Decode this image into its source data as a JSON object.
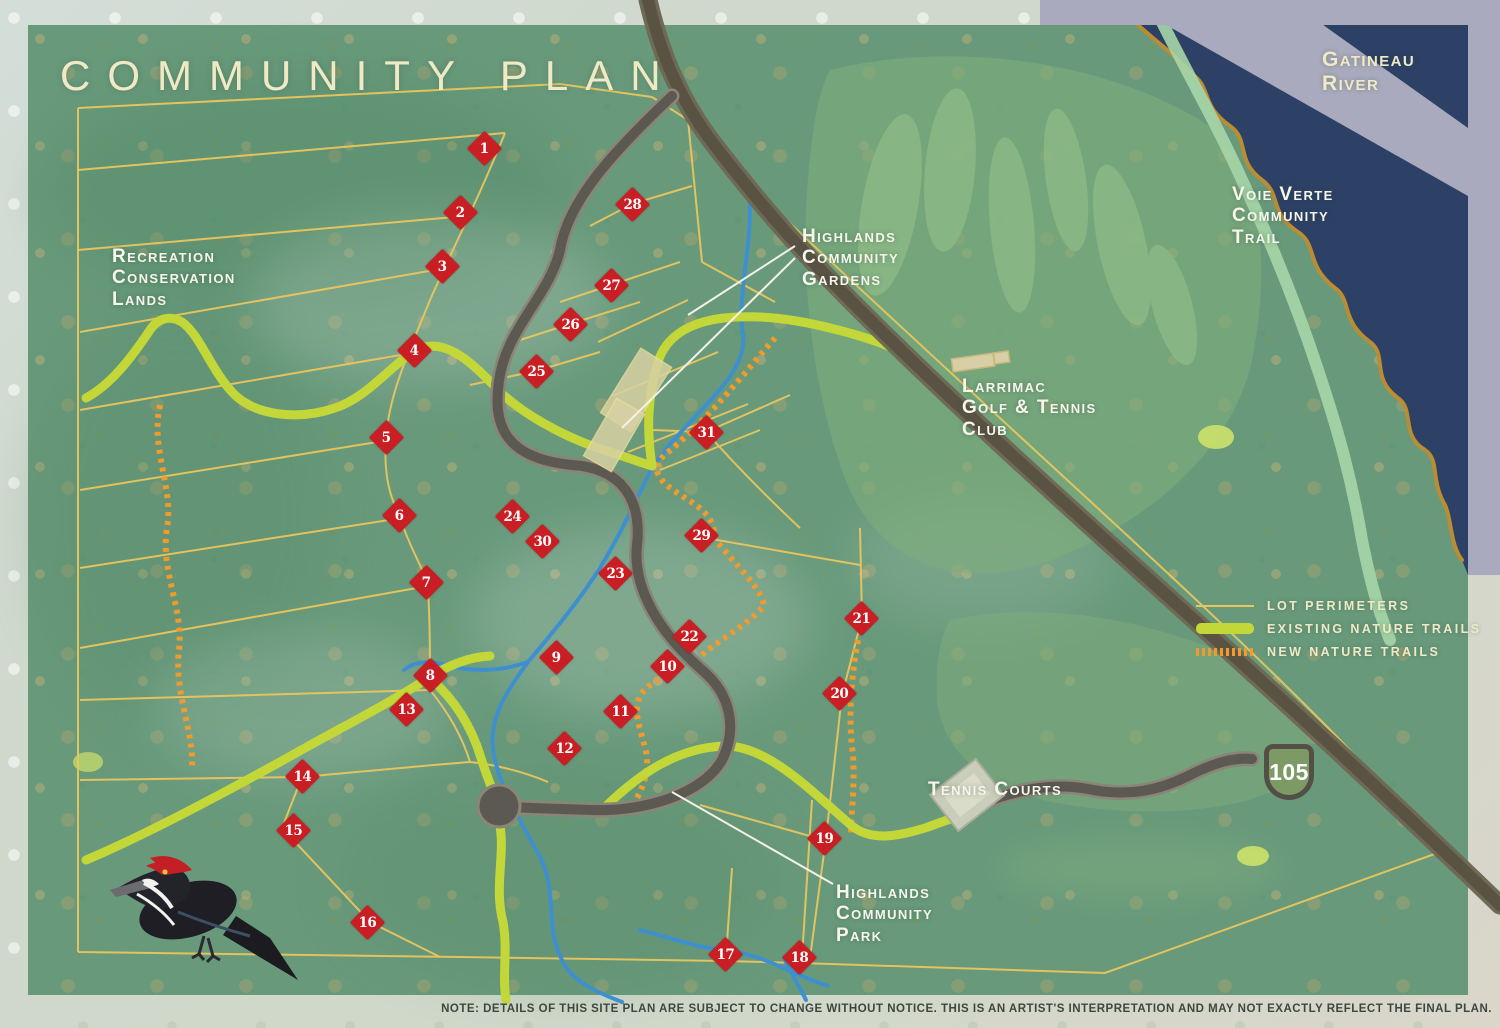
{
  "title": "COMMUNITY PLAN",
  "labels": {
    "gatineau_river": "Gatineau\nRiver",
    "voie_verte": "Voie Verte\nCommunity\nTrail",
    "recreation_lands": "Recreation\nConservation\nLands",
    "highlands_gardens": "Highlands\nCommunity\nGardens",
    "larrimac_club": "Larrimac\nGolf & Tennis\nClub",
    "tennis_courts": "Tennis Courts",
    "highlands_park": "Highlands\nCommunity\nPark"
  },
  "legend": {
    "items": [
      {
        "label": "LOT PERIMETERS",
        "swatch": "lot-perimeter-line"
      },
      {
        "label": "EXISTING NATURE TRAILS",
        "swatch": "existing-trail-bar"
      },
      {
        "label": "NEW NATURE TRAILS",
        "swatch": "new-trail-dashes"
      }
    ]
  },
  "highway_shield": "105",
  "note": "NOTE: DETAILS OF THIS SITE PLAN ARE SUBJECT TO CHANGE WITHOUT NOTICE.  THIS IS AN ARTIST'S INTERPRETATION AND MAY NOT EXACTLY REFLECT THE FINAL PLAN.",
  "markers": [
    {
      "n": 1,
      "x": 484,
      "y": 148
    },
    {
      "n": 2,
      "x": 460,
      "y": 212
    },
    {
      "n": 3,
      "x": 442,
      "y": 266
    },
    {
      "n": 4,
      "x": 414,
      "y": 350
    },
    {
      "n": 5,
      "x": 386,
      "y": 437
    },
    {
      "n": 6,
      "x": 399,
      "y": 515
    },
    {
      "n": 7,
      "x": 426,
      "y": 582
    },
    {
      "n": 8,
      "x": 430,
      "y": 675
    },
    {
      "n": 9,
      "x": 556,
      "y": 657
    },
    {
      "n": 10,
      "x": 667,
      "y": 666
    },
    {
      "n": 11,
      "x": 620,
      "y": 711
    },
    {
      "n": 12,
      "x": 564,
      "y": 748
    },
    {
      "n": 13,
      "x": 406,
      "y": 709
    },
    {
      "n": 14,
      "x": 302,
      "y": 776
    },
    {
      "n": 15,
      "x": 293,
      "y": 830
    },
    {
      "n": 16,
      "x": 367,
      "y": 922
    },
    {
      "n": 17,
      "x": 725,
      "y": 954
    },
    {
      "n": 18,
      "x": 799,
      "y": 957
    },
    {
      "n": 19,
      "x": 824,
      "y": 838
    },
    {
      "n": 20,
      "x": 839,
      "y": 693
    },
    {
      "n": 21,
      "x": 861,
      "y": 618
    },
    {
      "n": 22,
      "x": 689,
      "y": 636
    },
    {
      "n": 23,
      "x": 615,
      "y": 573
    },
    {
      "n": 24,
      "x": 512,
      "y": 516
    },
    {
      "n": 25,
      "x": 536,
      "y": 371
    },
    {
      "n": 26,
      "x": 570,
      "y": 324
    },
    {
      "n": 27,
      "x": 611,
      "y": 285
    },
    {
      "n": 28,
      "x": 632,
      "y": 204
    },
    {
      "n": 29,
      "x": 701,
      "y": 535
    },
    {
      "n": 30,
      "x": 542,
      "y": 541
    },
    {
      "n": 31,
      "x": 706,
      "y": 432
    }
  ],
  "colors": {
    "map_green": "#68997b",
    "river": "#2d4166",
    "shoreline": "#bb8d33",
    "lavender": "#a9aabd",
    "lot_line": "#e8c55e",
    "stream": "#3e8fd0",
    "existing_trail": "#c3d838",
    "new_trail": "#ef9b2d",
    "voie_verte": "#a6d6a7",
    "highway": "#5a5344",
    "highway_casing": "#6f6a56",
    "road": "#5c5952",
    "road_casing": "#8a8577",
    "marker_red": "#c81e24",
    "cream": "#f0e9c6",
    "label_white": "#f7f5ec",
    "note": "#3d4741",
    "garden": "#d8d2a4",
    "shield_green": "#7e9a64",
    "shield_border": "#544f46"
  }
}
